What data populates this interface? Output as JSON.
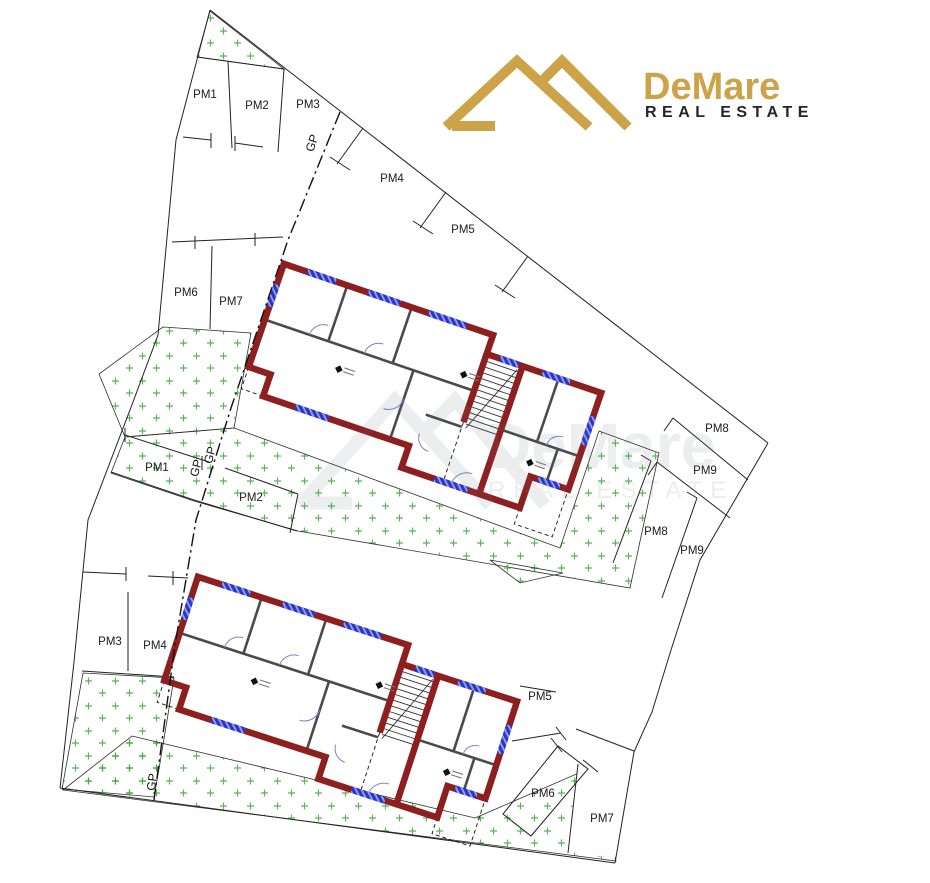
{
  "brand": {
    "name": "DeMare",
    "tagline": "REAL ESTATE"
  },
  "watermark": {
    "name": "DeMare",
    "tagline": "REAL ESTATE"
  },
  "gp": {
    "top": "GP",
    "mid_a": "GP",
    "mid_b": "GP",
    "bottom": "GP"
  },
  "parcels": {
    "upper": {
      "pm1": "PM1",
      "pm2": "PM2",
      "pm3": "PM3",
      "pm4": "PM4",
      "pm5": "PM5",
      "pm6": "PM6",
      "pm7": "PM7",
      "pm8": "PM8",
      "pm9": "PM9"
    },
    "lower": {
      "pm1": "PM1",
      "pm2": "PM2",
      "pm3": "PM3",
      "pm4": "PM4",
      "pm5": "PM5",
      "pm6": "PM6",
      "pm7": "PM7",
      "pm8": "PM8",
      "pm9": "PM9"
    }
  },
  "colors": {
    "logo_gold": "#cda349",
    "tagline_dark": "#23252e",
    "wall_red": "#8e1f1f",
    "window_blue": "#2a35cf",
    "grass_green": "#3da93d",
    "line_black": "#1c1c1c"
  }
}
